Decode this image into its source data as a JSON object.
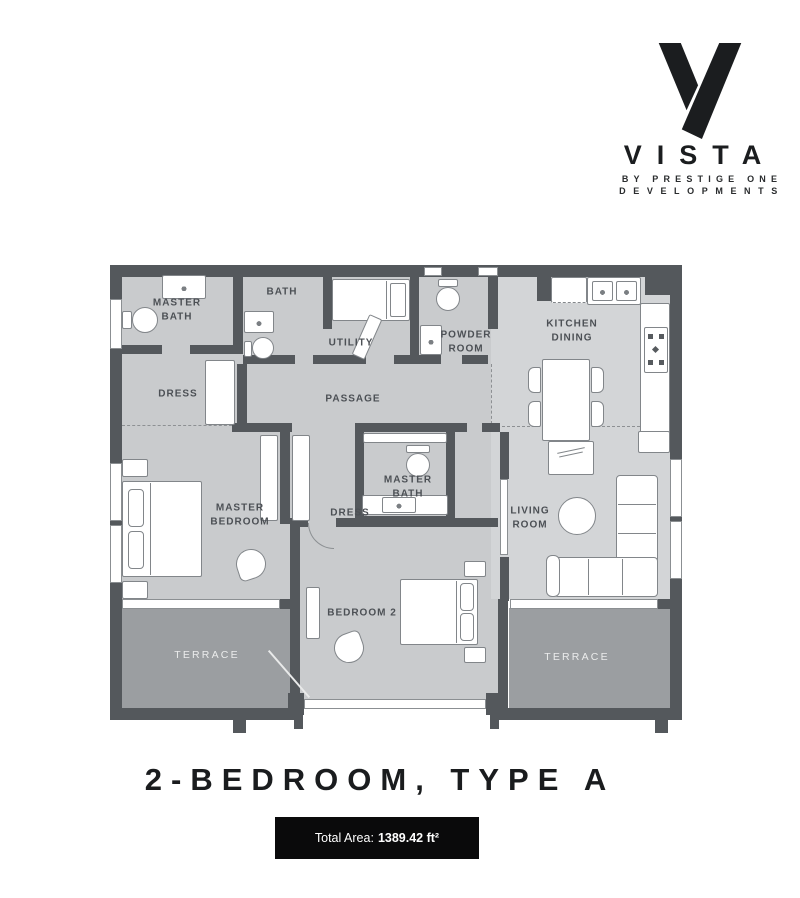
{
  "brand": {
    "name": "VISTA",
    "tagline_line1": "BY PRESTIGE ONE",
    "tagline_line2": "DEVELOPMENTS"
  },
  "plan": {
    "rooms": {
      "master_bath_1": "MASTER\nBATH",
      "bath": "BATH",
      "utility": "UTILITY",
      "powder_room": "POWDER\nROOM",
      "kitchen_dining": "KITCHEN\nDINING",
      "dress_1": "DRESS",
      "passage": "PASSAGE",
      "master_bedroom": "MASTER\nBEDROOM",
      "master_bath_2": "MASTER\nBATH",
      "dress_2": "DRESS",
      "living_room": "LIVING\nROOM",
      "bedroom_2": "BEDROOM 2",
      "terrace_left": "TERRACE",
      "terrace_right": "TERRACE"
    }
  },
  "footer": {
    "title": "2-BEDROOM, TYPE A",
    "total_area_label": "Total Area:",
    "total_area_value": "1389.42 ft²"
  },
  "colors": {
    "wall": "#54585c",
    "floor": "#c9cbcd",
    "floor_light": "#d3d5d7",
    "terrace": "#9b9ea1",
    "label_text": "#4c5055",
    "badge_bg": "#0a0a0b",
    "brand_ink": "#1b1d1f"
  }
}
